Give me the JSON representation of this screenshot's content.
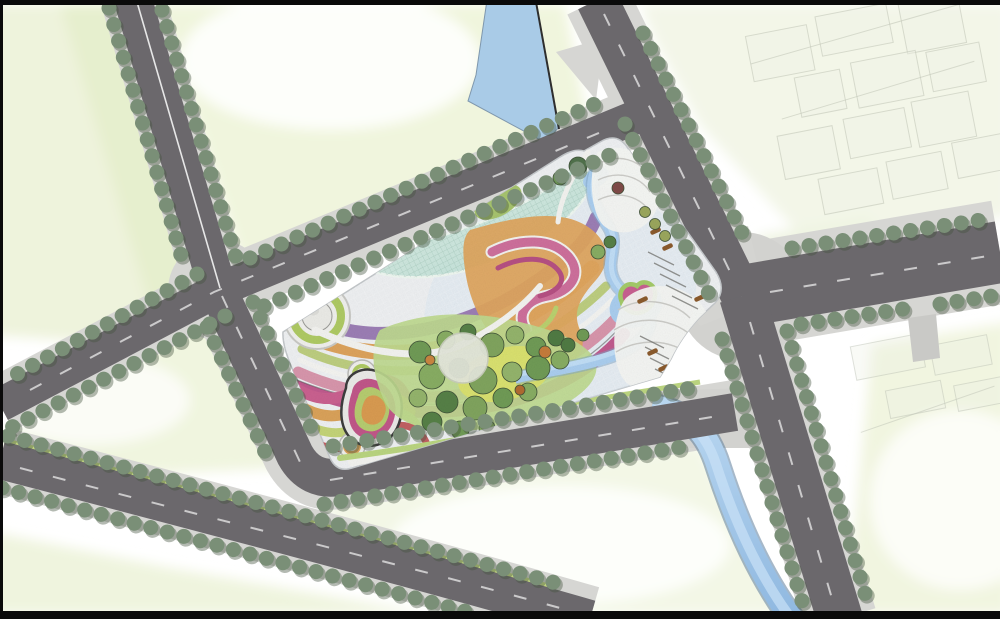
{
  "meta": {
    "type": "landscape-architecture-master-plan",
    "view": "top-down-site-plan-rendering",
    "canvas": {
      "width": 1000,
      "height": 619
    },
    "text_content": "none-visible"
  },
  "palette": {
    "bg": "#ffffff",
    "frame": "#0a0a0a",
    "parcel": "#eef3dc",
    "parcelDeep": "#e3edcb",
    "road": "#6b686c",
    "sidewalk": "#d6d6d3",
    "plaza": "#d2d2cf",
    "water": "#a9cbe7",
    "waterDeep": "#7fa3c4",
    "waterLight": "#c9e1f6",
    "tree": "#7a8f77",
    "treeShadow": "#44523f",
    "paving": "#eceef0",
    "pavingBlue": "#dde7f0",
    "roofMint": "#d8ece4",
    "roofMintDeep": "#b9ded6",
    "bandPurple": "#9b7db4",
    "bandOrange": "#dca25b",
    "bandGreen": "#bccd7f",
    "bandPink": "#d795ab",
    "bandMagenta": "#bf5a8d",
    "bandRed": "#c05f62",
    "lawn": "#bdd88e",
    "meadow": "#dde269",
    "grove1": "#6f9a55",
    "grove2": "#87ac62",
    "grove3": "#557f46",
    "grove4": "#93b36b",
    "whitePath": "#f2f2ef",
    "whitePlaza": "#f3f4f1",
    "bench": "#8a5a2c",
    "ghostFill": "#edefe5",
    "ghostLine": "#b7bcae",
    "verge": "#c3d780"
  },
  "scene": {
    "site": {
      "name": "central-park-site",
      "features": [
        "curved-grid-roof-building",
        "sweeping-colored-terrace-bands",
        "serpentine-pink-magenta-bands",
        "spiral-ring-mound",
        "small-ring-mounds",
        "teardrop-terraced-garden",
        "tree-grove-with-lawn-and-meadow",
        "white-fluffy-specimen-tree",
        "meandering-stream-with-pond",
        "play-mound-in-pond",
        "white-plaza-with-curved-paths",
        "hatched-paving-strips",
        "wood-benches"
      ]
    },
    "context": {
      "roads": [
        "northwest-street",
        "west-intersection-cross-street",
        "site-north-street",
        "top-canal-street",
        "east-boulevard",
        "southeast-street",
        "site-south-street",
        "southwest-street-pair"
      ],
      "water": [
        "north-canal",
        "east-canal"
      ],
      "streetscape": "tree-lined-roads-with-sidewalks-and-dashed-lane-lines",
      "parcels": "pale-green-undeveloped-blocks",
      "existing_buildings": "faint-footprint-outlines-top-right-and-bottom-right"
    }
  }
}
